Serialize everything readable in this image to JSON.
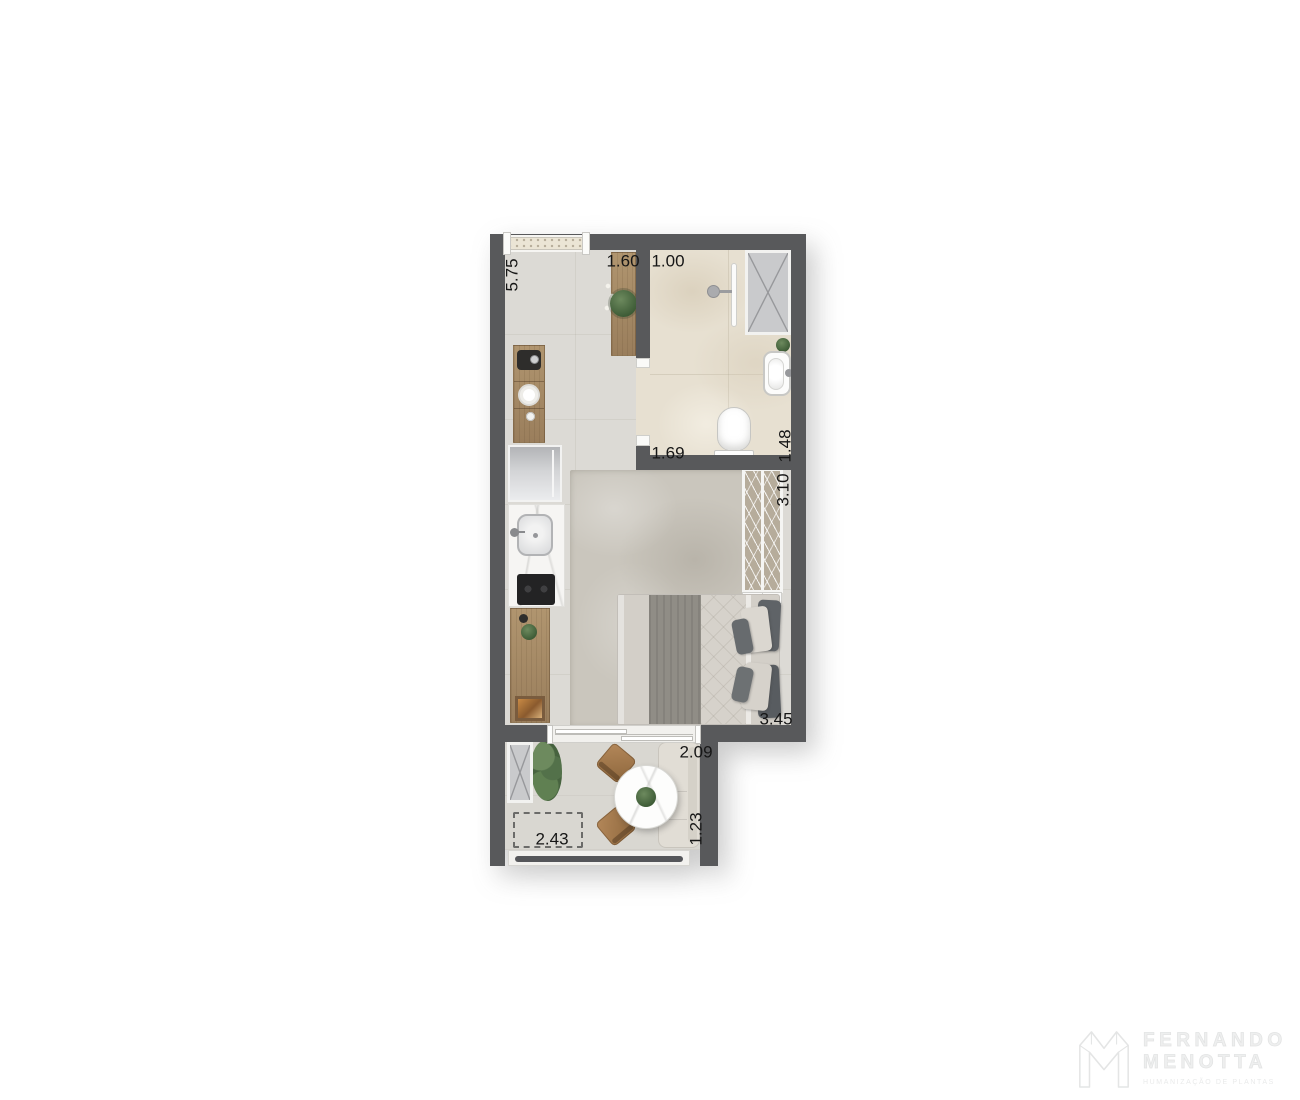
{
  "plan_labels": [
    {
      "id": "window-width",
      "text": "5.75",
      "orientation": "vertical"
    },
    {
      "id": "entry-width",
      "text": "1.60",
      "orientation": "horizontal"
    },
    {
      "id": "bath-door-width",
      "text": "1.00",
      "orientation": "horizontal"
    },
    {
      "id": "bath-width",
      "text": "1.69",
      "orientation": "horizontal"
    },
    {
      "id": "bath-depth",
      "text": "1.48",
      "orientation": "vertical"
    },
    {
      "id": "wardrobe-length",
      "text": "3.10",
      "orientation": "vertical"
    },
    {
      "id": "bedroom-width",
      "text": "3.45",
      "orientation": "horizontal"
    },
    {
      "id": "balcony-door-width",
      "text": "2.09",
      "orientation": "horizontal"
    },
    {
      "id": "balcony-depth",
      "text": "1.23",
      "orientation": "vertical"
    },
    {
      "id": "balcony-width",
      "text": "2.43",
      "orientation": "horizontal"
    }
  ],
  "watermark": {
    "brand_top": "FERNANDO",
    "brand_bottom": "MENOTTA",
    "tagline": "HUMANIZAÇÃO DE PLANTAS"
  },
  "colors": {
    "wall": "#58595B",
    "floor_main": "#DCDAD5",
    "floor_bathroom": "#E7E0D1",
    "floor_balcony": "#D9D7D1",
    "rug": "#CAC6BD",
    "wood": "#A88C6A",
    "shaft_gray": "#C9CACC",
    "bed_throw": "#908D86",
    "pillow_dark": "#5E6266",
    "chair_wood": "#A87F53",
    "plant_green": "#4E6E45",
    "dimension_text": "#161616",
    "watermark_gray": "#ECEDED"
  },
  "furniture": {
    "kitchen": [
      "entry-console",
      "potted-plant",
      "coffee-machine",
      "plate",
      "burner-knobs",
      "refrigerator",
      "kitchen-sink",
      "cooktop",
      "lower-counter",
      "picture-frame"
    ],
    "bathroom": [
      "duct-shaft",
      "shower-glass",
      "shower-head",
      "washbasin",
      "toilet",
      "small-plant"
    ],
    "bedroom": [
      "wardrobe",
      "headboard-shelf",
      "double-bed",
      "area-rug"
    ],
    "balcony": [
      "duct-shaft",
      "bush",
      "round-table",
      "dining-chair",
      "dining-chair",
      "bench-sofa",
      "floor-mat",
      "railing"
    ]
  }
}
